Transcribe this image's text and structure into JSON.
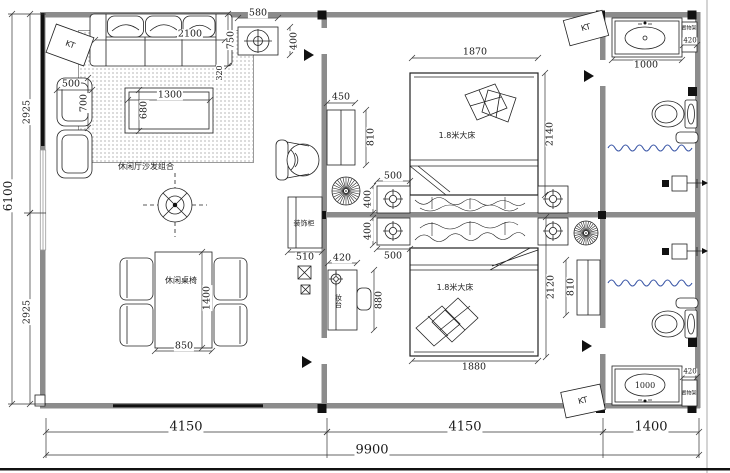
{
  "drawing": {
    "kind": "residential floor plan",
    "rooms": {
      "living_room_label": "休闲厅沙发组合",
      "dining_label": "休闲桌椅",
      "bedroom1_bed_label": "1.8米大床",
      "bedroom2_bed_label": "1.8米大床",
      "cabinet_label": "装饰柜",
      "dresser_label": "妆台",
      "shelf_label_top": "置物架",
      "shelf_label_bottom": "置物架",
      "ac_unit_label": "KT"
    },
    "overall_dimensions": {
      "width_mm": "9900",
      "height_mm": "6100",
      "bottom_segments_mm": [
        "4150",
        "4150",
        "1400"
      ],
      "left_segments_mm": [
        "2925",
        "2925"
      ]
    }
  },
  "colors": {
    "line": "#222222",
    "wall": "#8c8c8c",
    "curtain_wave": "#3a56a6",
    "carpet_dot": "#bdbdbd"
  },
  "labels": [
    {
      "t": "2100",
      "x": 190,
      "y": 34,
      "cls": "dim"
    },
    {
      "t": "750",
      "x": 231,
      "y": 40,
      "r": -90,
      "cls": "dim"
    },
    {
      "t": "320",
      "x": 220,
      "y": 73,
      "r": -90,
      "s": 8,
      "cls": "dim"
    },
    {
      "t": "580",
      "x": 258,
      "y": 13,
      "cls": "dim"
    },
    {
      "t": "400",
      "x": 294,
      "y": 41,
      "r": -90,
      "cls": "dim"
    },
    {
      "t": "500",
      "x": 71,
      "y": 84,
      "cls": "dim"
    },
    {
      "t": "700",
      "x": 84,
      "y": 103,
      "r": -90,
      "cls": "dim"
    },
    {
      "t": "1300",
      "x": 170,
      "y": 95,
      "cls": "dim"
    },
    {
      "t": "680",
      "x": 144,
      "y": 110,
      "r": -90,
      "cls": "dim"
    },
    {
      "t": "1400",
      "x": 207,
      "y": 298,
      "r": -90,
      "cls": "dim"
    },
    {
      "t": "850",
      "x": 184,
      "y": 346,
      "cls": "dim"
    },
    {
      "t": "1870",
      "x": 475,
      "y": 52,
      "cls": "dim"
    },
    {
      "t": "2140",
      "x": 550,
      "y": 134,
      "r": -90,
      "cls": "dim"
    },
    {
      "t": "450",
      "x": 341,
      "y": 97,
      "cls": "dim"
    },
    {
      "t": "810",
      "x": 371,
      "y": 137,
      "r": -90,
      "cls": "dim"
    },
    {
      "t": "500",
      "x": 393,
      "y": 176,
      "cls": "dim"
    },
    {
      "t": "400",
      "x": 368,
      "y": 199,
      "r": -90,
      "cls": "dim"
    },
    {
      "t": "400",
      "x": 368,
      "y": 231,
      "r": -90,
      "cls": "dim"
    },
    {
      "t": "500",
      "x": 393,
      "y": 256,
      "cls": "dim"
    },
    {
      "t": "510",
      "x": 305,
      "y": 257,
      "cls": "dim"
    },
    {
      "t": "420",
      "x": 342,
      "y": 258,
      "cls": "dim"
    },
    {
      "t": "880",
      "x": 379,
      "y": 300,
      "r": -90,
      "cls": "dim"
    },
    {
      "t": "1880",
      "x": 474,
      "y": 367,
      "cls": "dim"
    },
    {
      "t": "2120",
      "x": 551,
      "y": 287,
      "r": -90,
      "cls": "dim"
    },
    {
      "t": "810",
      "x": 571,
      "y": 287,
      "r": -90,
      "cls": "dim"
    },
    {
      "t": "1000",
      "x": 646,
      "y": 65,
      "cls": "dim"
    },
    {
      "t": "420",
      "x": 690,
      "y": 41,
      "s": 7,
      "cls": "dim"
    },
    {
      "t": "1000",
      "x": 645,
      "y": 386,
      "s": 8,
      "cls": "dim"
    },
    {
      "t": "420",
      "x": 690,
      "y": 372,
      "s": 7,
      "cls": "dim"
    },
    {
      "t": "4150",
      "x": 186,
      "y": 427,
      "s": 13,
      "cls": "dim"
    },
    {
      "t": "4150",
      "x": 465,
      "y": 427,
      "s": 13,
      "cls": "dim"
    },
    {
      "t": "1400",
      "x": 651,
      "y": 427,
      "s": 13,
      "cls": "dim"
    },
    {
      "t": "9900",
      "x": 372,
      "y": 450,
      "s": 13,
      "cls": "dim"
    },
    {
      "t": "6100",
      "x": 8,
      "y": 196,
      "r": -90,
      "s": 12,
      "cls": "dim"
    },
    {
      "t": "2925",
      "x": 27,
      "y": 112,
      "r": -90,
      "cls": "dim"
    },
    {
      "t": "2925",
      "x": 27,
      "y": 312,
      "r": -90,
      "cls": "dim"
    },
    {
      "t": "休闲厅沙发组合",
      "x": 146,
      "y": 167,
      "s": 8,
      "cls": "room"
    },
    {
      "t": "休闲桌椅",
      "x": 181,
      "y": 281,
      "s": 8,
      "cls": "room"
    },
    {
      "t": "1.8米大床",
      "x": 457,
      "y": 136,
      "s": 8,
      "cls": "room"
    },
    {
      "t": "1.8米大床",
      "x": 455,
      "y": 288,
      "s": 8,
      "cls": "room"
    },
    {
      "t": "装饰柜",
      "x": 304,
      "y": 224,
      "s": 7,
      "cls": "room"
    },
    {
      "t": "妆台",
      "x": 338,
      "y": 301,
      "s": 7,
      "cls": "room",
      "vert": true
    },
    {
      "t": "置物架",
      "x": 689,
      "y": 29,
      "s": 5,
      "cls": "room"
    },
    {
      "t": "置物架",
      "x": 689,
      "y": 394,
      "s": 5,
      "cls": "room"
    },
    {
      "t": "KT",
      "x": 70,
      "y": 45,
      "r": 20,
      "s": 8,
      "cls": "kt"
    },
    {
      "t": "KT",
      "x": 586,
      "y": 28,
      "r": -15,
      "s": 8,
      "cls": "kt"
    },
    {
      "t": "KT",
      "x": 583,
      "y": 401,
      "r": -12,
      "s": 8,
      "cls": "kt"
    }
  ]
}
